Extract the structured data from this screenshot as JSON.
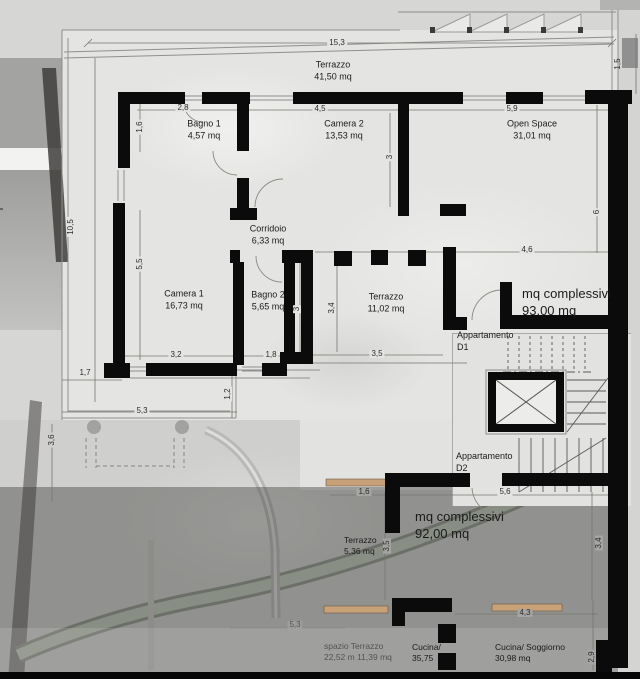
{
  "title": "Pianta appartamenti D1 e D2",
  "colors": {
    "wall": "#0b0b0b",
    "floor": "#e4e4e2",
    "lower_floor_shadow": "rgba(52,52,50,0.40)",
    "garden_band": "#bcc4b4",
    "window_sill": "#c9a178",
    "linework": "#6b6b69",
    "dim_text": "#2d2d2b"
  },
  "units": "mq",
  "apartments": [
    {
      "id": "D1",
      "label_lines": [
        "Appartamento",
        "D1"
      ],
      "total_lines": [
        "mq complessivi",
        "93,00 mq"
      ]
    },
    {
      "id": "D2",
      "label_lines": [
        "Appartamento",
        "D2"
      ],
      "total_lines": [
        "mq complessivi",
        "92,00 mq"
      ]
    }
  ],
  "labels": [
    {
      "id": "terrazzo-top",
      "lines": [
        "Terrazzo",
        "41,50 mq"
      ],
      "x": 333,
      "y": 71,
      "align": "c",
      "size": 9
    },
    {
      "id": "bagno-1",
      "lines": [
        "Bagno 1",
        "4,57 mq"
      ],
      "x": 204,
      "y": 130,
      "align": "c",
      "size": 9
    },
    {
      "id": "camera-2",
      "lines": [
        "Camera 2",
        "13,53 mq"
      ],
      "x": 344,
      "y": 130,
      "align": "c",
      "size": 9
    },
    {
      "id": "open-space",
      "lines": [
        "Open Space",
        "31,01 mq"
      ],
      "x": 532,
      "y": 130,
      "align": "c",
      "size": 9
    },
    {
      "id": "corridoio",
      "lines": [
        "Corridoio",
        "6,33 mq"
      ],
      "x": 268,
      "y": 235,
      "align": "c",
      "size": 9
    },
    {
      "id": "camera-1",
      "lines": [
        "Camera 1",
        "16,73 mq"
      ],
      "x": 184,
      "y": 300,
      "align": "c",
      "size": 9
    },
    {
      "id": "bagno-2",
      "lines": [
        "Bagno 2",
        "5,65 mq"
      ],
      "x": 268,
      "y": 301,
      "align": "c",
      "size": 9
    },
    {
      "id": "terrazzo-mid",
      "lines": [
        "Terrazzo",
        "11,02 mq"
      ],
      "x": 386,
      "y": 303,
      "align": "c",
      "size": 9
    },
    {
      "id": "appartamento-d1",
      "lines": [
        "Appartamento",
        "D1"
      ],
      "x": 457,
      "y": 330,
      "align": "l",
      "size": 9
    },
    {
      "id": "totale-d1",
      "lines": [
        "mq complessivi",
        "93,00 mq"
      ],
      "x": 522,
      "y": 286,
      "align": "l",
      "size": 13
    },
    {
      "id": "appartamento-d2",
      "lines": [
        "Appartamento",
        "D2"
      ],
      "x": 456,
      "y": 451,
      "align": "l",
      "size": 9
    },
    {
      "id": "totale-d2",
      "lines": [
        "mq complessivi",
        "92,00 mq"
      ],
      "x": 415,
      "y": 509,
      "align": "l",
      "size": 13
    },
    {
      "id": "terrazzo-d2",
      "lines": [
        "Terrazzo",
        "5,36 mq"
      ],
      "x": 344,
      "y": 535,
      "align": "l",
      "size": 8.5
    },
    {
      "id": "spazio-terrazzo",
      "lines": [
        "spazio Terrazzo",
        "22,52 m 11,39 mq"
      ],
      "x": 324,
      "y": 641,
      "align": "l",
      "size": 8.5,
      "color": "#3f3f3d",
      "opacity": 0.8
    },
    {
      "id": "cucina",
      "lines": [
        "Cucina/",
        "35,75"
      ],
      "x": 412,
      "y": 642,
      "align": "l",
      "size": 8.5
    },
    {
      "id": "cucina-soggiorno",
      "lines": [
        "Cucina/ Soggiorno",
        "30,98 mq"
      ],
      "x": 495,
      "y": 642,
      "align": "l",
      "size": 8.5
    }
  ],
  "dimensions": [
    {
      "v": "15,3",
      "x": 337,
      "y": 43,
      "rot": 0,
      "bg": "u"
    },
    {
      "v": "2,8",
      "x": 183,
      "y": 108,
      "rot": 0,
      "bg": "u"
    },
    {
      "v": "4,5",
      "x": 320,
      "y": 109,
      "rot": 0,
      "bg": "u"
    },
    {
      "v": "5,9",
      "x": 512,
      "y": 109,
      "rot": 0,
      "bg": "u"
    },
    {
      "v": "1,5",
      "x": 618,
      "y": 64,
      "rot": 90,
      "bg": "n"
    },
    {
      "v": "1,6",
      "x": 140,
      "y": 127,
      "rot": 90,
      "bg": "u"
    },
    {
      "v": "3",
      "x": 390,
      "y": 157,
      "rot": 90,
      "bg": "u"
    },
    {
      "v": "10,5",
      "x": 71,
      "y": 227,
      "rot": 90,
      "bg": "u"
    },
    {
      "v": "5,5",
      "x": 140,
      "y": 264,
      "rot": 90,
      "bg": "u"
    },
    {
      "v": "4,6",
      "x": 527,
      "y": 250,
      "rot": 0,
      "bg": "u"
    },
    {
      "v": "6",
      "x": 597,
      "y": 212,
      "rot": 90,
      "bg": "u"
    },
    {
      "v": "3",
      "x": 297,
      "y": 309,
      "rot": 90,
      "bg": "u"
    },
    {
      "v": "3,4",
      "x": 332,
      "y": 308,
      "rot": 90,
      "bg": "u"
    },
    {
      "v": "3,5",
      "x": 377,
      "y": 354,
      "rot": 0,
      "bg": "u"
    },
    {
      "v": "3,2",
      "x": 176,
      "y": 355,
      "rot": 0,
      "bg": "u"
    },
    {
      "v": "1,8",
      "x": 271,
      "y": 355,
      "rot": 0,
      "bg": "u"
    },
    {
      "v": "1,7",
      "x": 85,
      "y": 373,
      "rot": 0,
      "bg": "u"
    },
    {
      "v": "1,2",
      "x": 228,
      "y": 394,
      "rot": 90,
      "bg": "u"
    },
    {
      "v": "5,3",
      "x": 142,
      "y": 411,
      "rot": 0,
      "bg": "u"
    },
    {
      "v": "3,6",
      "x": 52,
      "y": 440,
      "rot": 90,
      "bg": "m"
    },
    {
      "v": "1,6",
      "x": 364,
      "y": 492,
      "rot": 0,
      "bg": "l"
    },
    {
      "v": "5,6",
      "x": 505,
      "y": 492,
      "rot": 0,
      "bg": "u"
    },
    {
      "v": "3,5",
      "x": 387,
      "y": 546,
      "rot": 90,
      "bg": "l"
    },
    {
      "v": "3,4",
      "x": 599,
      "y": 543,
      "rot": 90,
      "bg": "l"
    },
    {
      "v": "5,3",
      "x": 295,
      "y": 625,
      "rot": 0,
      "bg": "l",
      "opacity": 0.6
    },
    {
      "v": "4,3",
      "x": 525,
      "y": 613,
      "rot": 0,
      "bg": "l"
    },
    {
      "v": "2,9",
      "x": 592,
      "y": 657,
      "rot": 90,
      "bg": "l"
    }
  ],
  "site_mark": "+"
}
